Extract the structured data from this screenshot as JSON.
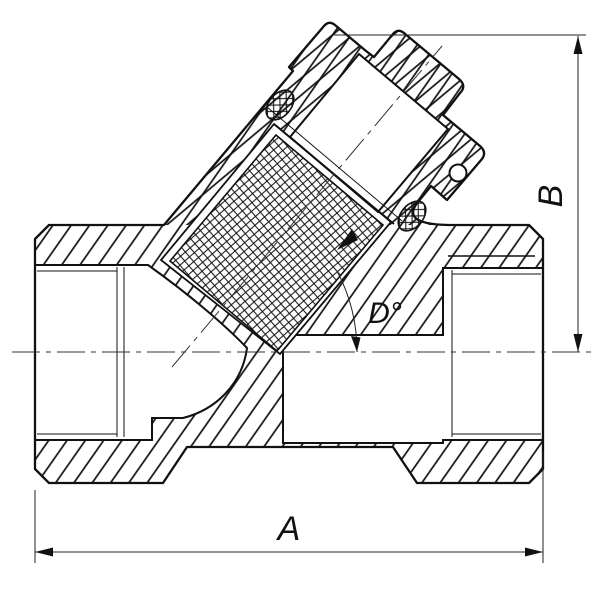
{
  "drawing": {
    "type": "technical-section-drawing",
    "subject": "y-strainer-valve-cross-section",
    "background_color": "#ffffff",
    "line_color": "#111111",
    "labels": {
      "width_dim": "A",
      "height_dim": "B",
      "angle_dim": "D°"
    }
  }
}
